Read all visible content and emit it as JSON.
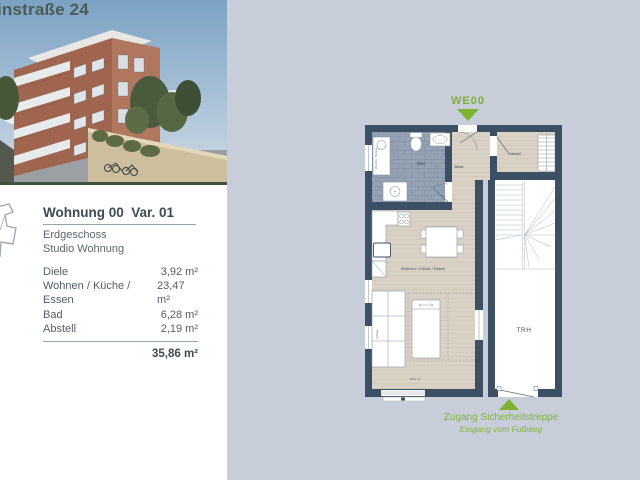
{
  "page": {
    "colors": {
      "background": "#c8cdda",
      "accent_green": "#7cb331",
      "wall": "#3c5065",
      "floor_wood": "#dad2c4",
      "floor_tile": "#94a2b4",
      "title_green": "#4c5b55"
    }
  },
  "header": {
    "title": "instraße 24"
  },
  "info": {
    "title": "Wohnung 00  Var. 01",
    "floor": "Erdgeschoss",
    "type": "Studio Wohnung",
    "rooms": [
      {
        "name": "Diele",
        "area": "3,92 m²"
      },
      {
        "name": "Wohnen / Küche / Essen",
        "area": "23,47 m²"
      },
      {
        "name": "Bad",
        "area": "6,28 m²"
      },
      {
        "name": "Abstell",
        "area": "2,19 m²"
      }
    ],
    "total": "35,86 m²"
  },
  "floorplan": {
    "unit_label": "WE00",
    "rooms": {
      "bad": "Bad",
      "diele": "Diele",
      "abstell": "Abstell",
      "trh": "TRH",
      "living": "Wohnen / Küche / Essen"
    },
    "annotations": {
      "washer": "Waschm. Trockner",
      "wardrobe": "Schrank",
      "brh": "BRH 30"
    },
    "access_label": "Zugang Sicherheitstreppe",
    "access_sublabel": "Eingang vom Fußweg"
  }
}
